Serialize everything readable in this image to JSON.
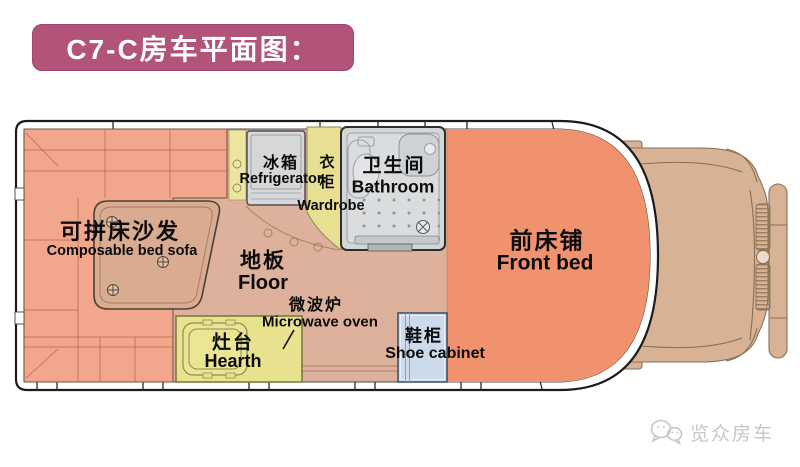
{
  "title": {
    "text": "C7-C房车平面图："
  },
  "colors": {
    "banner": "#b25379",
    "sofa": "#f2a68b",
    "front_bed": "#f0926e",
    "floor": "#ddb19b",
    "table": "#d9ab90",
    "cab": "#d8b295",
    "cabinet_yellow": "#ece6a0",
    "wardrobe_yellow": "#e7e092",
    "hearth_yellow": "#e8e28f",
    "fridge_gray": "#d5d7d9",
    "bathroom_gray": "#d3d5d7",
    "shoe_cabinet_blue": "#ccdbeb",
    "outline_dark": "#1c1c1c",
    "label_text": "#0b0b0b",
    "watermark_gray": "#c7c7c7"
  },
  "plan": {
    "areas": {
      "sofa": {
        "zh": "可拼床沙发",
        "en": "Composable bed sofa"
      },
      "refrigerator": {
        "zh": "冰箱",
        "en": "Refrigerator"
      },
      "wardrobe": {
        "zh": "衣柜",
        "en": "Wardrobe"
      },
      "bathroom": {
        "zh": "卫生间",
        "en": "Bathroom"
      },
      "floor": {
        "zh": "地板",
        "en": "Floor"
      },
      "front_bed": {
        "zh": "前床铺",
        "en": "Front bed"
      },
      "microwave": {
        "zh": "微波炉",
        "en": "Microwave oven"
      },
      "hearth": {
        "zh": "灶台",
        "en": "Hearth"
      },
      "shoe_cabinet": {
        "zh": "鞋柜",
        "en": "Shoe cabinet"
      }
    }
  },
  "watermark": {
    "brand": "览众房车",
    "icon": "wechat-icon"
  }
}
